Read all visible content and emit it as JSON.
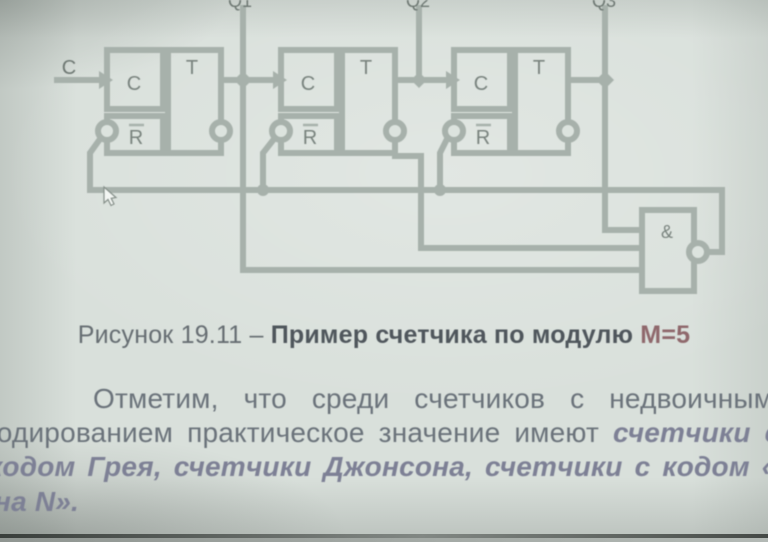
{
  "circuit": {
    "clock_input_label": "C",
    "outputs": [
      {
        "label": "Q1"
      },
      {
        "label": "Q2"
      },
      {
        "label": "Q3"
      }
    ],
    "flipflops": [
      {
        "clock": "C",
        "mode": "T",
        "reset": "R"
      },
      {
        "clock": "C",
        "mode": "T",
        "reset": "R"
      },
      {
        "clock": "C",
        "mode": "T",
        "reset": "R"
      }
    ],
    "gate": {
      "label": "&"
    },
    "colors": {
      "wire": "#a7b1ab",
      "label": "#79837e",
      "background": "#d9e0db"
    }
  },
  "caption": {
    "normal": "Рисунок 19.11 – ",
    "bold": "Пример счетчика по модулю ",
    "highlight": "М=5",
    "highlight_color": "#8f686c"
  },
  "paragraph": {
    "line1": "Отметим, что среди счетчиков с недвоичным",
    "line2_normal": "кодированием практическое значение имеют ",
    "line2_em": "счетчики с",
    "line3": "кодом Грея, счетчики Джонсона, счетчики с кодом «1",
    "line4": "на N»."
  }
}
